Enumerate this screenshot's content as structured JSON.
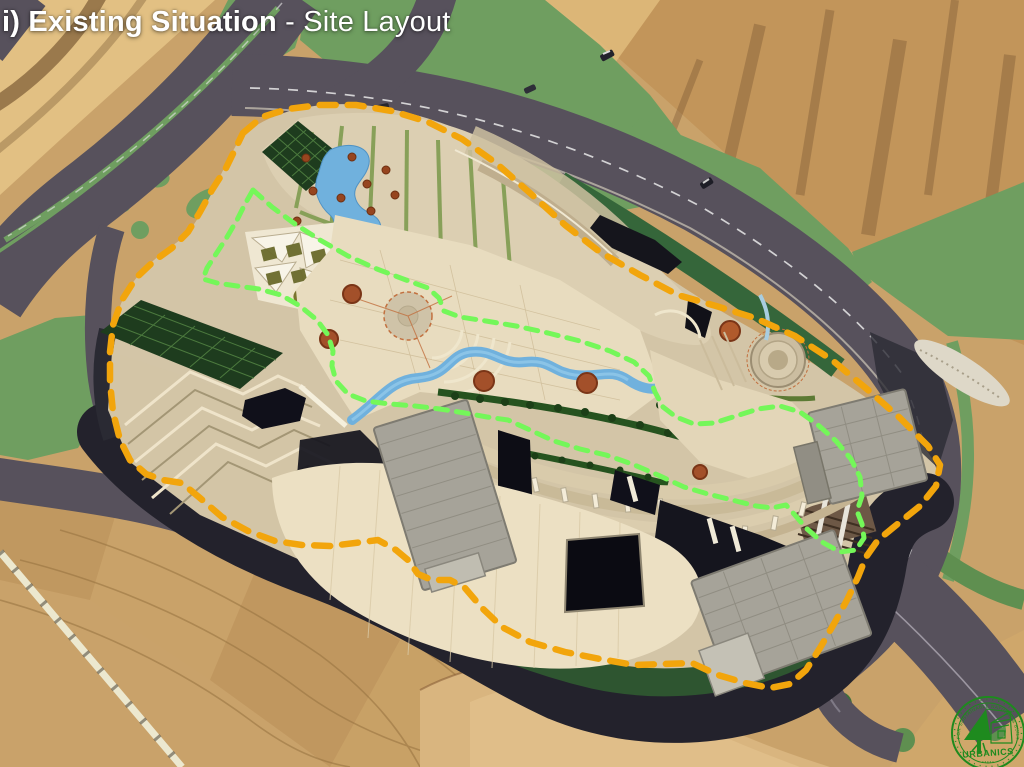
{
  "slide": {
    "title_bold": "i) Existing Situation",
    "title_regular": " - Site Layout"
  },
  "annotations": {
    "site_boundary": {
      "id": "site-boundary",
      "color": "#F2A50C",
      "dash": "16 12"
    },
    "inner_zone": {
      "id": "inner-zone",
      "color": "#74F759",
      "dash": "12 9"
    }
  },
  "logo": {
    "org": "URBANICS",
    "motto": "FOR SUSTAINABLE NATURAL & BUILT",
    "marks": "▪ ▪ ▪ ▪ ▪",
    "color": "#1E8A1E"
  },
  "palette": {
    "terrain": "#C9A26A",
    "rock": "#C2955A",
    "road": "#57515C",
    "green": "#6F9E60",
    "dark_green": "#2E5530",
    "water": "#70B1DD",
    "site_base": "#D3C5A7",
    "plaza": "#ECE0C3",
    "shadow": "#23222C",
    "roof_gray": "#A6A399",
    "roof_green": "#1E3C1E"
  }
}
